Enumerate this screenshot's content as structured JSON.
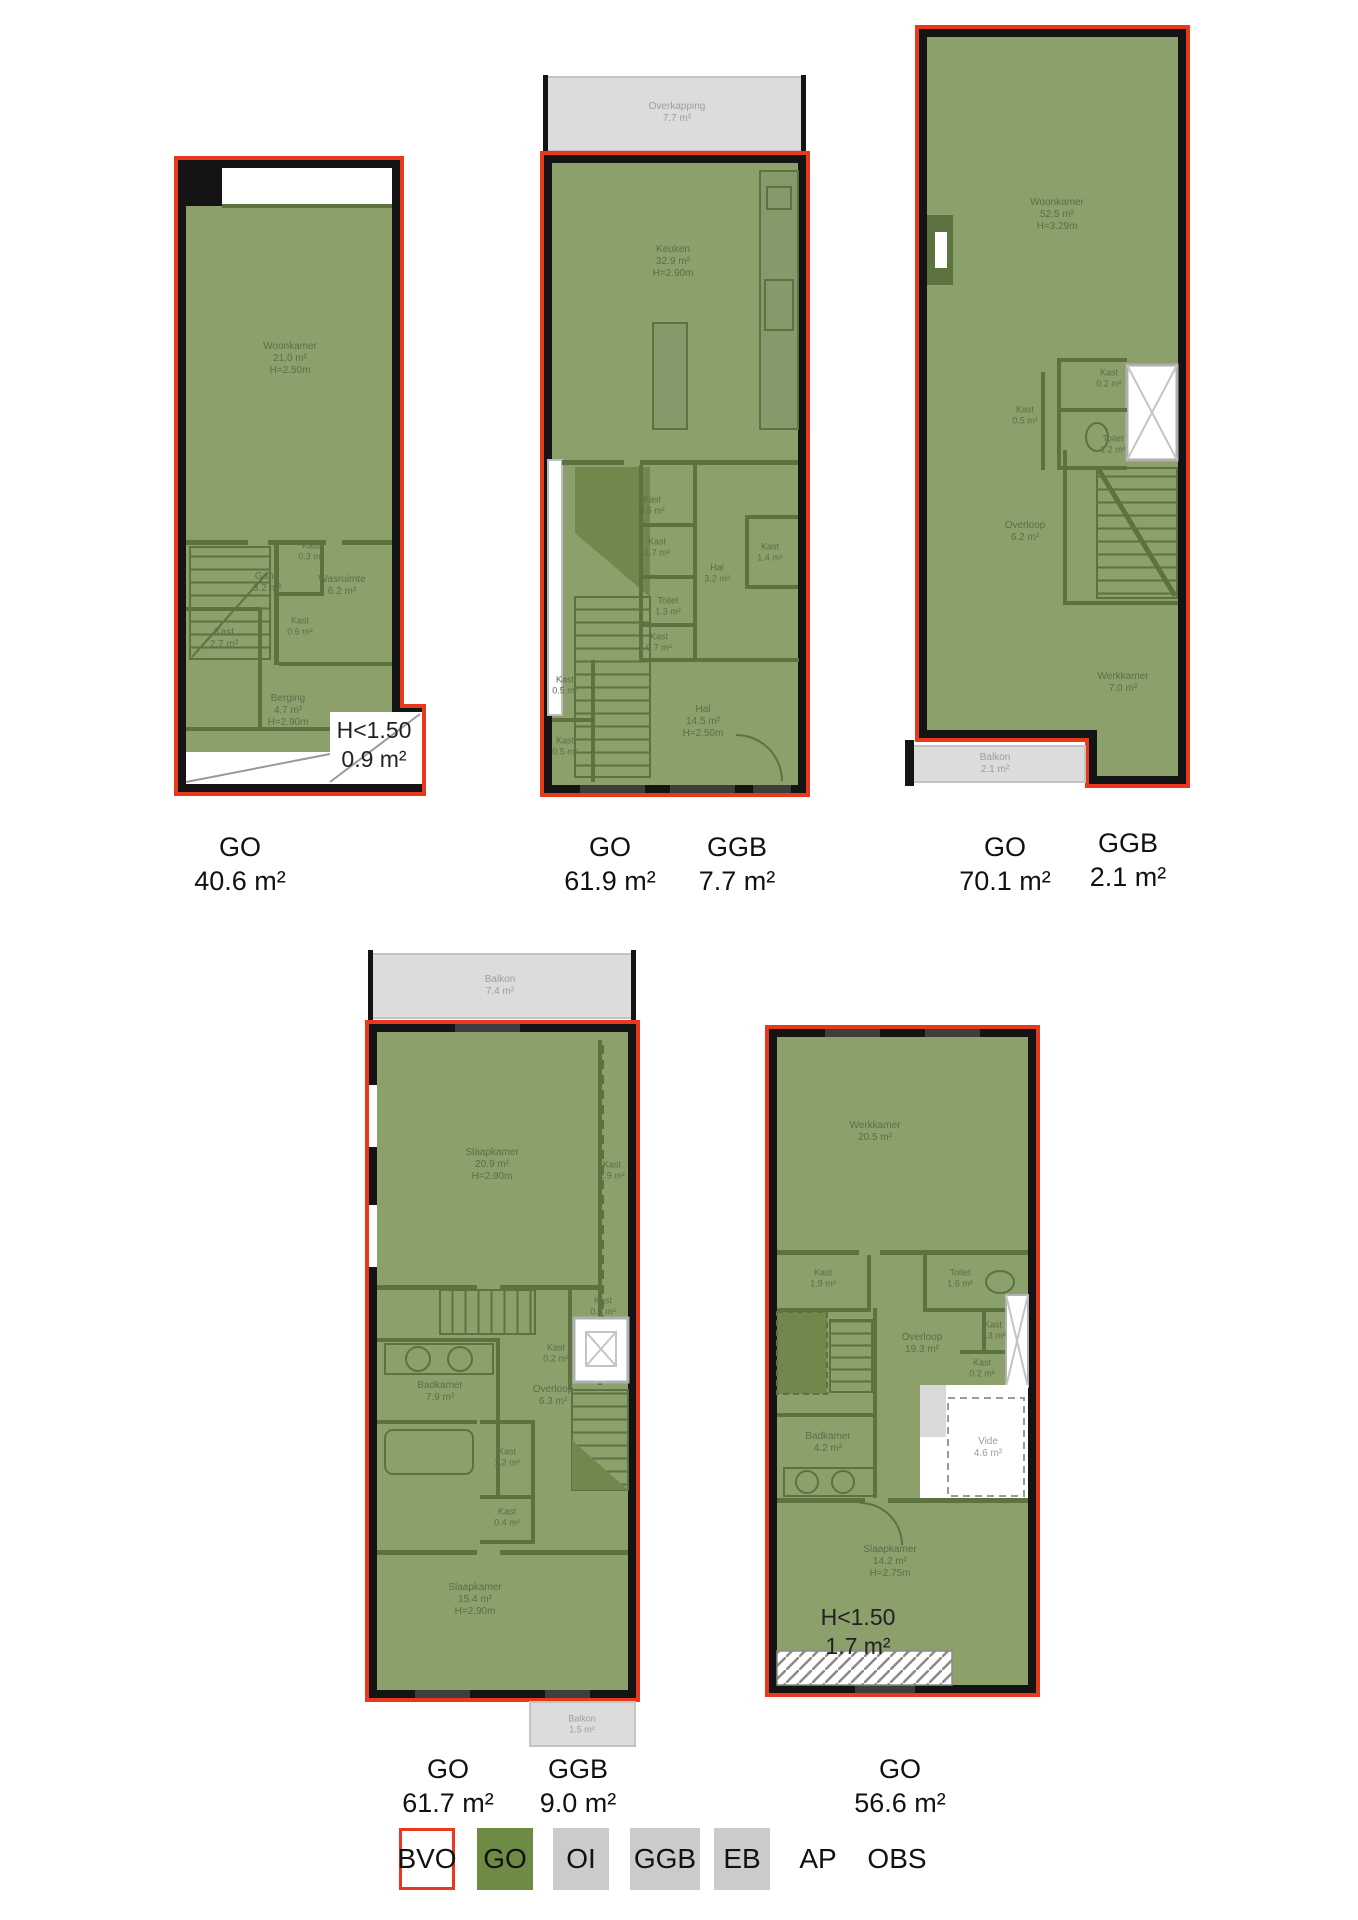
{
  "palette": {
    "bvo_outline_red": "#e8391c",
    "go_fill_green": "#8ca06c",
    "go_legend_green": "#6e8b45",
    "wall_black": "#141414",
    "interior_wall_green": "#5c7340",
    "ggb_gray": "#dcdcdc",
    "legend_gray": "#cbcbcb"
  },
  "plans": [
    {
      "id": "floorplan-1",
      "rooms": [
        {
          "name": "Woonkamer",
          "area": "21.0 m²",
          "height": "H=2.50m"
        },
        {
          "name": "Gang",
          "area": "3.2 m²"
        },
        {
          "name": "Kast",
          "area": "0.3 m²"
        },
        {
          "name": "Wasruimte",
          "area": "6.2 m²"
        },
        {
          "name": "Kast",
          "area": "2.7 m²"
        },
        {
          "name": "Kast",
          "area": "0.6 m²"
        },
        {
          "name": "Berging",
          "area": "4.7 m²",
          "height": "H=2.90m"
        }
      ],
      "h150": {
        "l1": "H<1.50",
        "l2": "0.9 m²"
      },
      "area_labels": [
        {
          "code": "GO",
          "value": "40.6 m²"
        }
      ]
    },
    {
      "id": "floorplan-2",
      "rooms": [
        {
          "name": "Overkapping",
          "area": "7.7 m²"
        },
        {
          "name": "Keuken",
          "area": "32.9 m²",
          "height": "H=2.90m"
        },
        {
          "name": "Kast",
          "area": "0.5 m²"
        },
        {
          "name": "Kast",
          "area": "1.7 m²"
        },
        {
          "name": "Kast",
          "area": "1.4 m²"
        },
        {
          "name": "Hal",
          "area": "3.2 m²"
        },
        {
          "name": "Toilet",
          "area": "1.3 m²"
        },
        {
          "name": "Kast",
          "area": "0.7 m²"
        },
        {
          "name": "Kast",
          "area": "0.5 m²"
        },
        {
          "name": "Kast",
          "area": "0.5 m²"
        },
        {
          "name": "Hal",
          "area": "14.5 m²",
          "height": "H=2.50m"
        }
      ],
      "area_labels": [
        {
          "code": "GO",
          "value": "61.9 m²"
        },
        {
          "code": "GGB",
          "value": "7.7 m²"
        }
      ]
    },
    {
      "id": "floorplan-3",
      "rooms": [
        {
          "name": "Woonkamer",
          "area": "52.5 m²",
          "height": "H=3.29m"
        },
        {
          "name": "Kast",
          "area": "0.2 m²"
        },
        {
          "name": "Kast",
          "area": "0.5 m²"
        },
        {
          "name": "Toilet",
          "area": "1.2 m²"
        },
        {
          "name": "Overloop",
          "area": "6.2 m²"
        },
        {
          "name": "Werkkamer",
          "area": "7.0 m²"
        },
        {
          "name": "Balkon",
          "area": "2.1 m²"
        }
      ],
      "area_labels": [
        {
          "code": "GO",
          "value": "70.1 m²"
        },
        {
          "code": "GGB",
          "value": "2.1 m²"
        }
      ]
    },
    {
      "id": "floorplan-4",
      "rooms": [
        {
          "name": "Balkon",
          "area": "7.4 m²"
        },
        {
          "name": "Slaapkamer",
          "area": "20.9 m²",
          "height": "H=2.90m"
        },
        {
          "name": "Kast",
          "area": "2.9 m²"
        },
        {
          "name": "Kast",
          "area": "0.5 m²"
        },
        {
          "name": "Kast",
          "area": "0.2 m²"
        },
        {
          "name": "Badkamer",
          "area": "7.9 m²"
        },
        {
          "name": "Overloop",
          "area": "6.3 m²"
        },
        {
          "name": "Kast",
          "area": "1.2 m²"
        },
        {
          "name": "Kast",
          "area": "0.4 m²"
        },
        {
          "name": "Slaapkamer",
          "area": "15.4 m²",
          "height": "H=2.90m"
        },
        {
          "name": "Balkon",
          "area": "1.5 m²"
        }
      ],
      "area_labels": [
        {
          "code": "GO",
          "value": "61.7 m²"
        },
        {
          "code": "GGB",
          "value": "9.0 m²"
        }
      ]
    },
    {
      "id": "floorplan-5",
      "rooms": [
        {
          "name": "Werkkamer",
          "area": "20.5 m²"
        },
        {
          "name": "Kast",
          "area": "1.9 m²"
        },
        {
          "name": "Toilet",
          "area": "1.6 m²"
        },
        {
          "name": "Overloop",
          "area": "19.3 m²"
        },
        {
          "name": "Kast",
          "area": "1.3 m²"
        },
        {
          "name": "Kast",
          "area": "0.2 m²"
        },
        {
          "name": "Badkamer",
          "area": "4.2 m²"
        },
        {
          "name": "Vide",
          "area": "4.6 m²"
        },
        {
          "name": "Slaapkamer",
          "area": "14.2 m²",
          "height": "H=2.75m"
        }
      ],
      "h150": {
        "l1": "H<1.50",
        "l2": "1.7 m²"
      },
      "area_labels": [
        {
          "code": "GO",
          "value": "56.6 m²"
        }
      ]
    }
  ],
  "legend": {
    "items": [
      {
        "label": "BVO",
        "fill": "#ffffff",
        "border": "#e8391c"
      },
      {
        "label": "GO",
        "fill": "#6e8b45"
      },
      {
        "label": "OI",
        "fill": "#cdcdcd"
      },
      {
        "label": "GGB",
        "fill": "#c9c9c9"
      },
      {
        "label": "EB",
        "fill": "#cbcbcb"
      },
      {
        "label": "AP",
        "fill": "none"
      },
      {
        "label": "OBS",
        "fill": "none"
      }
    ]
  }
}
